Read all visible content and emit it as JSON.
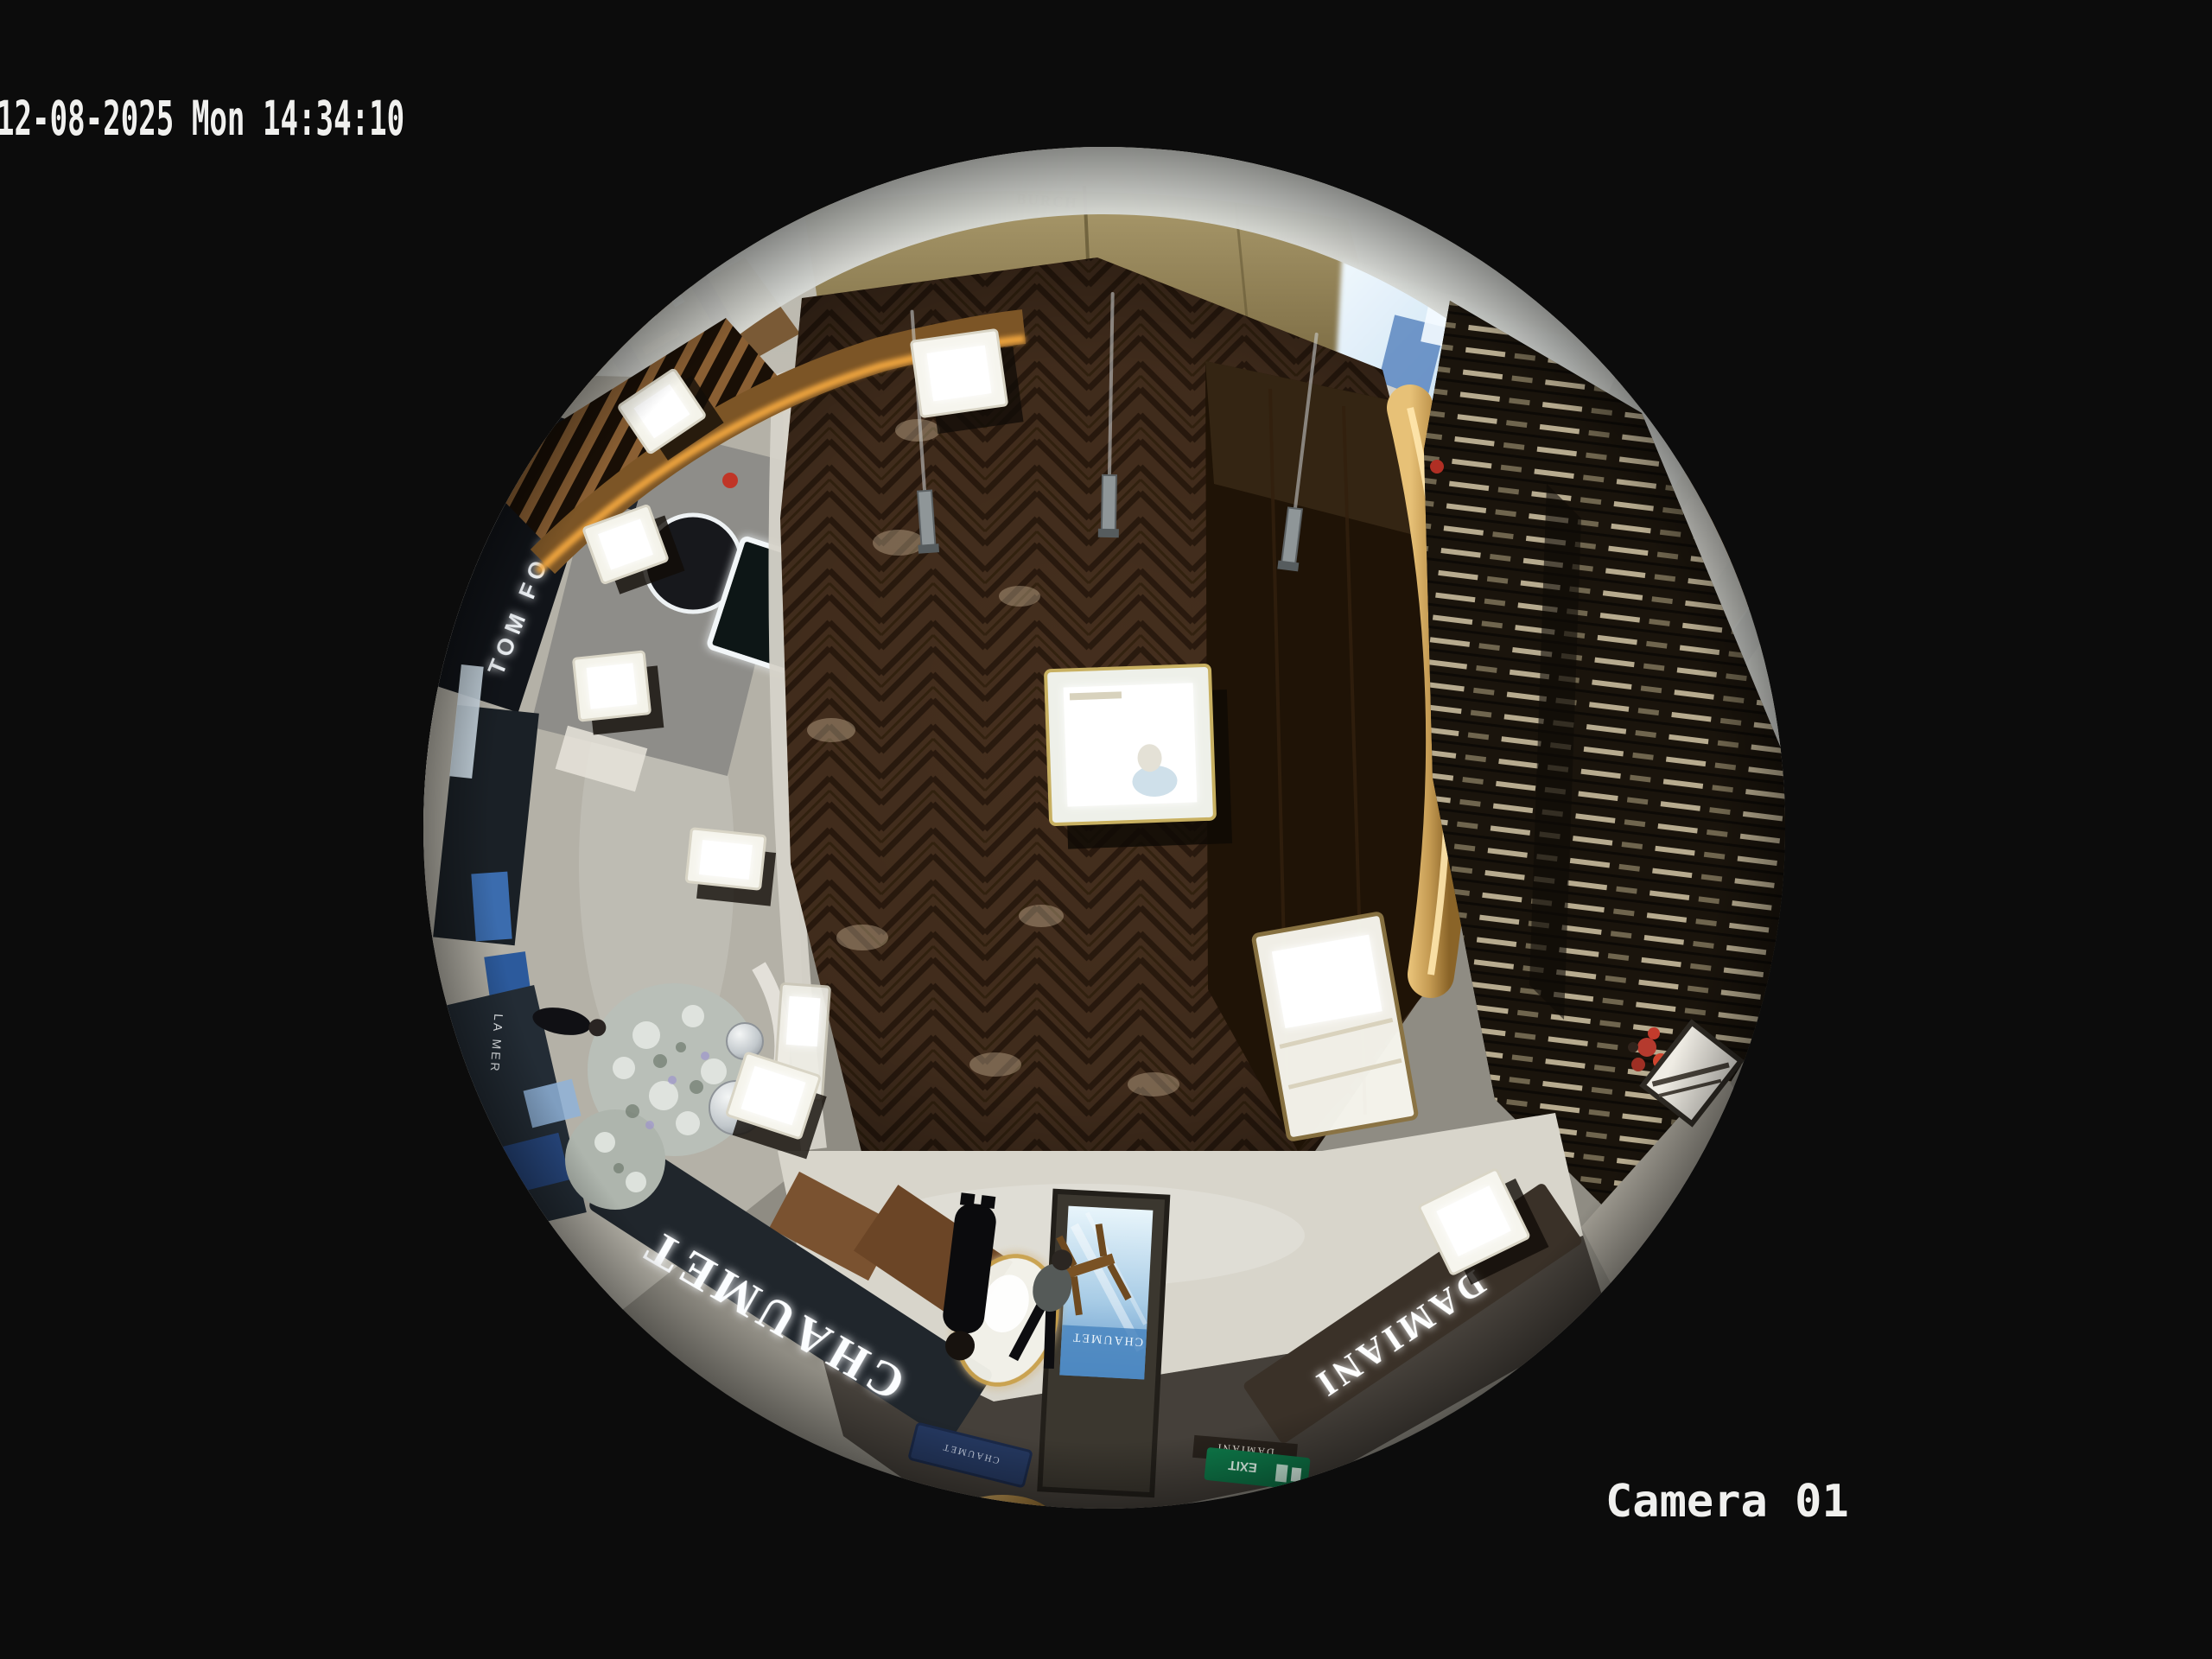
{
  "osd": {
    "timestamp": "12-08-2025 Mon 14:34:10",
    "camera_label": "Camera 01",
    "text_color": "#f0f0ee"
  },
  "signs": {
    "chaumet_fascia": "CHAUMET",
    "chaumet_plaque": "CHAUMET",
    "chaumet_kiosk": "CHAUMET",
    "damiani_fascia": "DAMIANI",
    "damiani_plaque": "DAMIANI",
    "tom_ford": "TOM FORD",
    "la_mer": "LA MER",
    "burch": "BURCH",
    "exit": "EXIT"
  },
  "scene": {
    "view": "fisheye-overhead",
    "colors": {
      "background": "#0c0c0c",
      "wood_floor": "#452f1e",
      "wood_stripe": "#2a1a0e",
      "tile_ring": "#c9c5bb",
      "marble_corridor": "#aeaba1",
      "ceiling_rim": "#d5d7d3",
      "fascia_dark": "#20262c",
      "screen_blue": "#8fb9e2",
      "gold_accent": "#c79a4e",
      "tree_silver": "#c3c9c2",
      "exit_green": "#0e7a4a",
      "alarm_red": "#c03527"
    }
  }
}
